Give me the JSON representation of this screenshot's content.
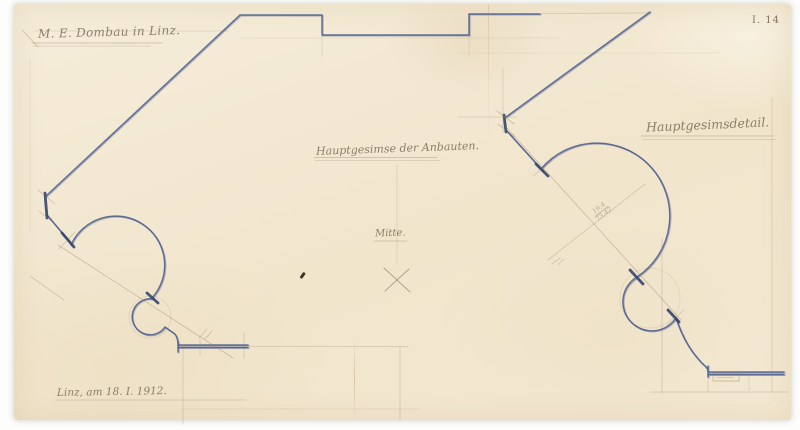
{
  "page": {
    "background": "#ffffff"
  },
  "drawing": {
    "medium": "blue ink and pencil architectural drawing on aged paper",
    "colors": {
      "paper": "#f3e9d2",
      "ink_blue": "#45588c",
      "pencil": "#8a7b5e",
      "scan_background": "#ffffff"
    },
    "inscriptions": {
      "office_top_left": "M. E. Dombau in Linz.",
      "title_center": "Hauptgesimse der Anbauten.",
      "center_mark": "Mitte.",
      "title_right": "Hauptgesimsdetail.",
      "place_date": "Linz, am 18. I. 1912.",
      "sheet_no": "I. 14",
      "calc_numerator": "19,4",
      "calc_denominator": "73,42"
    }
  }
}
